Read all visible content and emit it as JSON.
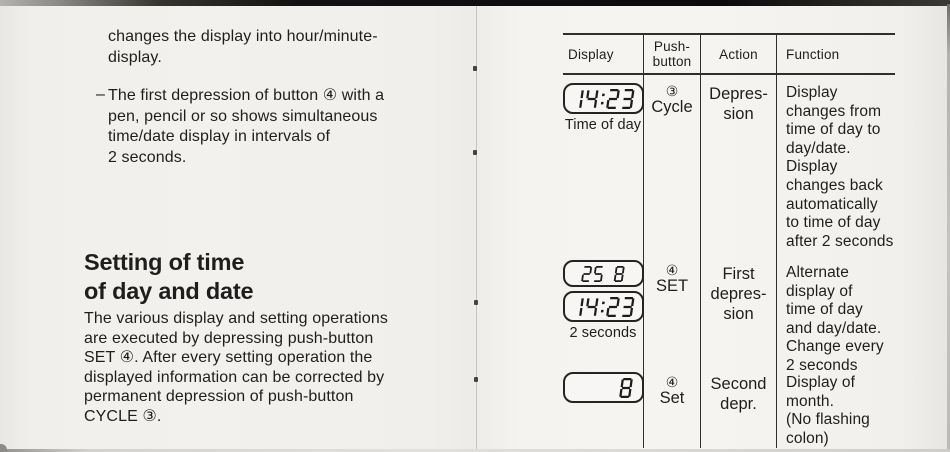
{
  "left_page": {
    "para1_lines": [
      "changes the display into hour/minute-",
      "display."
    ],
    "bullet": {
      "marker": "–",
      "lines": [
        "The first depression of button ④ with a",
        "pen, pencil or so shows simultaneous",
        "time/date display in intervals of",
        "2 seconds."
      ]
    },
    "heading_lines": [
      "Setting of time",
      "of day and date"
    ],
    "para2_lines": [
      "The various display and setting operations",
      "are executed by depressing push-button",
      "SET ④. After every setting operation the",
      "displayed information can be corrected by",
      "permanent depression of push-button",
      "CYCLE ③."
    ]
  },
  "table": {
    "header": {
      "display": "Display",
      "push_button_lines": [
        "Push-",
        "button"
      ],
      "action": "Action",
      "function": "Function"
    },
    "rows": [
      {
        "display": {
          "lcds": [
            {
              "value": "14:23"
            }
          ],
          "caption": "Time of day"
        },
        "push_button": {
          "symbol": "③",
          "label": "Cycle"
        },
        "action_lines": [
          "Depres-",
          "sion"
        ],
        "function_lines": [
          "Display",
          "changes from",
          "time of day to",
          "day/date.",
          "Display",
          "changes back",
          "automatically",
          "to time of day",
          "after 2 seconds"
        ]
      },
      {
        "display": {
          "lcds": [
            {
              "value": "25 8"
            },
            {
              "value": "14:23"
            }
          ],
          "caption": "2 seconds"
        },
        "push_button": {
          "symbol": "④",
          "label": "SET"
        },
        "action_lines": [
          "First",
          "depres-",
          "sion"
        ],
        "function_lines": [
          "Alternate",
          "display of",
          "time of day",
          "and day/date.",
          "Change every",
          "2 seconds"
        ]
      },
      {
        "display": {
          "lcds": [
            {
              "value": "8"
            }
          ],
          "caption": ""
        },
        "push_button": {
          "symbol": "④",
          "label": "Set"
        },
        "action_lines": [
          "Second",
          "depr."
        ],
        "function_lines": [
          "Display of month.",
          "(No flashing",
          "colon)"
        ]
      }
    ]
  },
  "colors": {
    "paper": "#f3f1ed",
    "ink": "#1e1e1e",
    "lcd_ink": "#1c1c1c",
    "table_line": "#2f2f2f",
    "top_band": "#0b0b0b"
  }
}
